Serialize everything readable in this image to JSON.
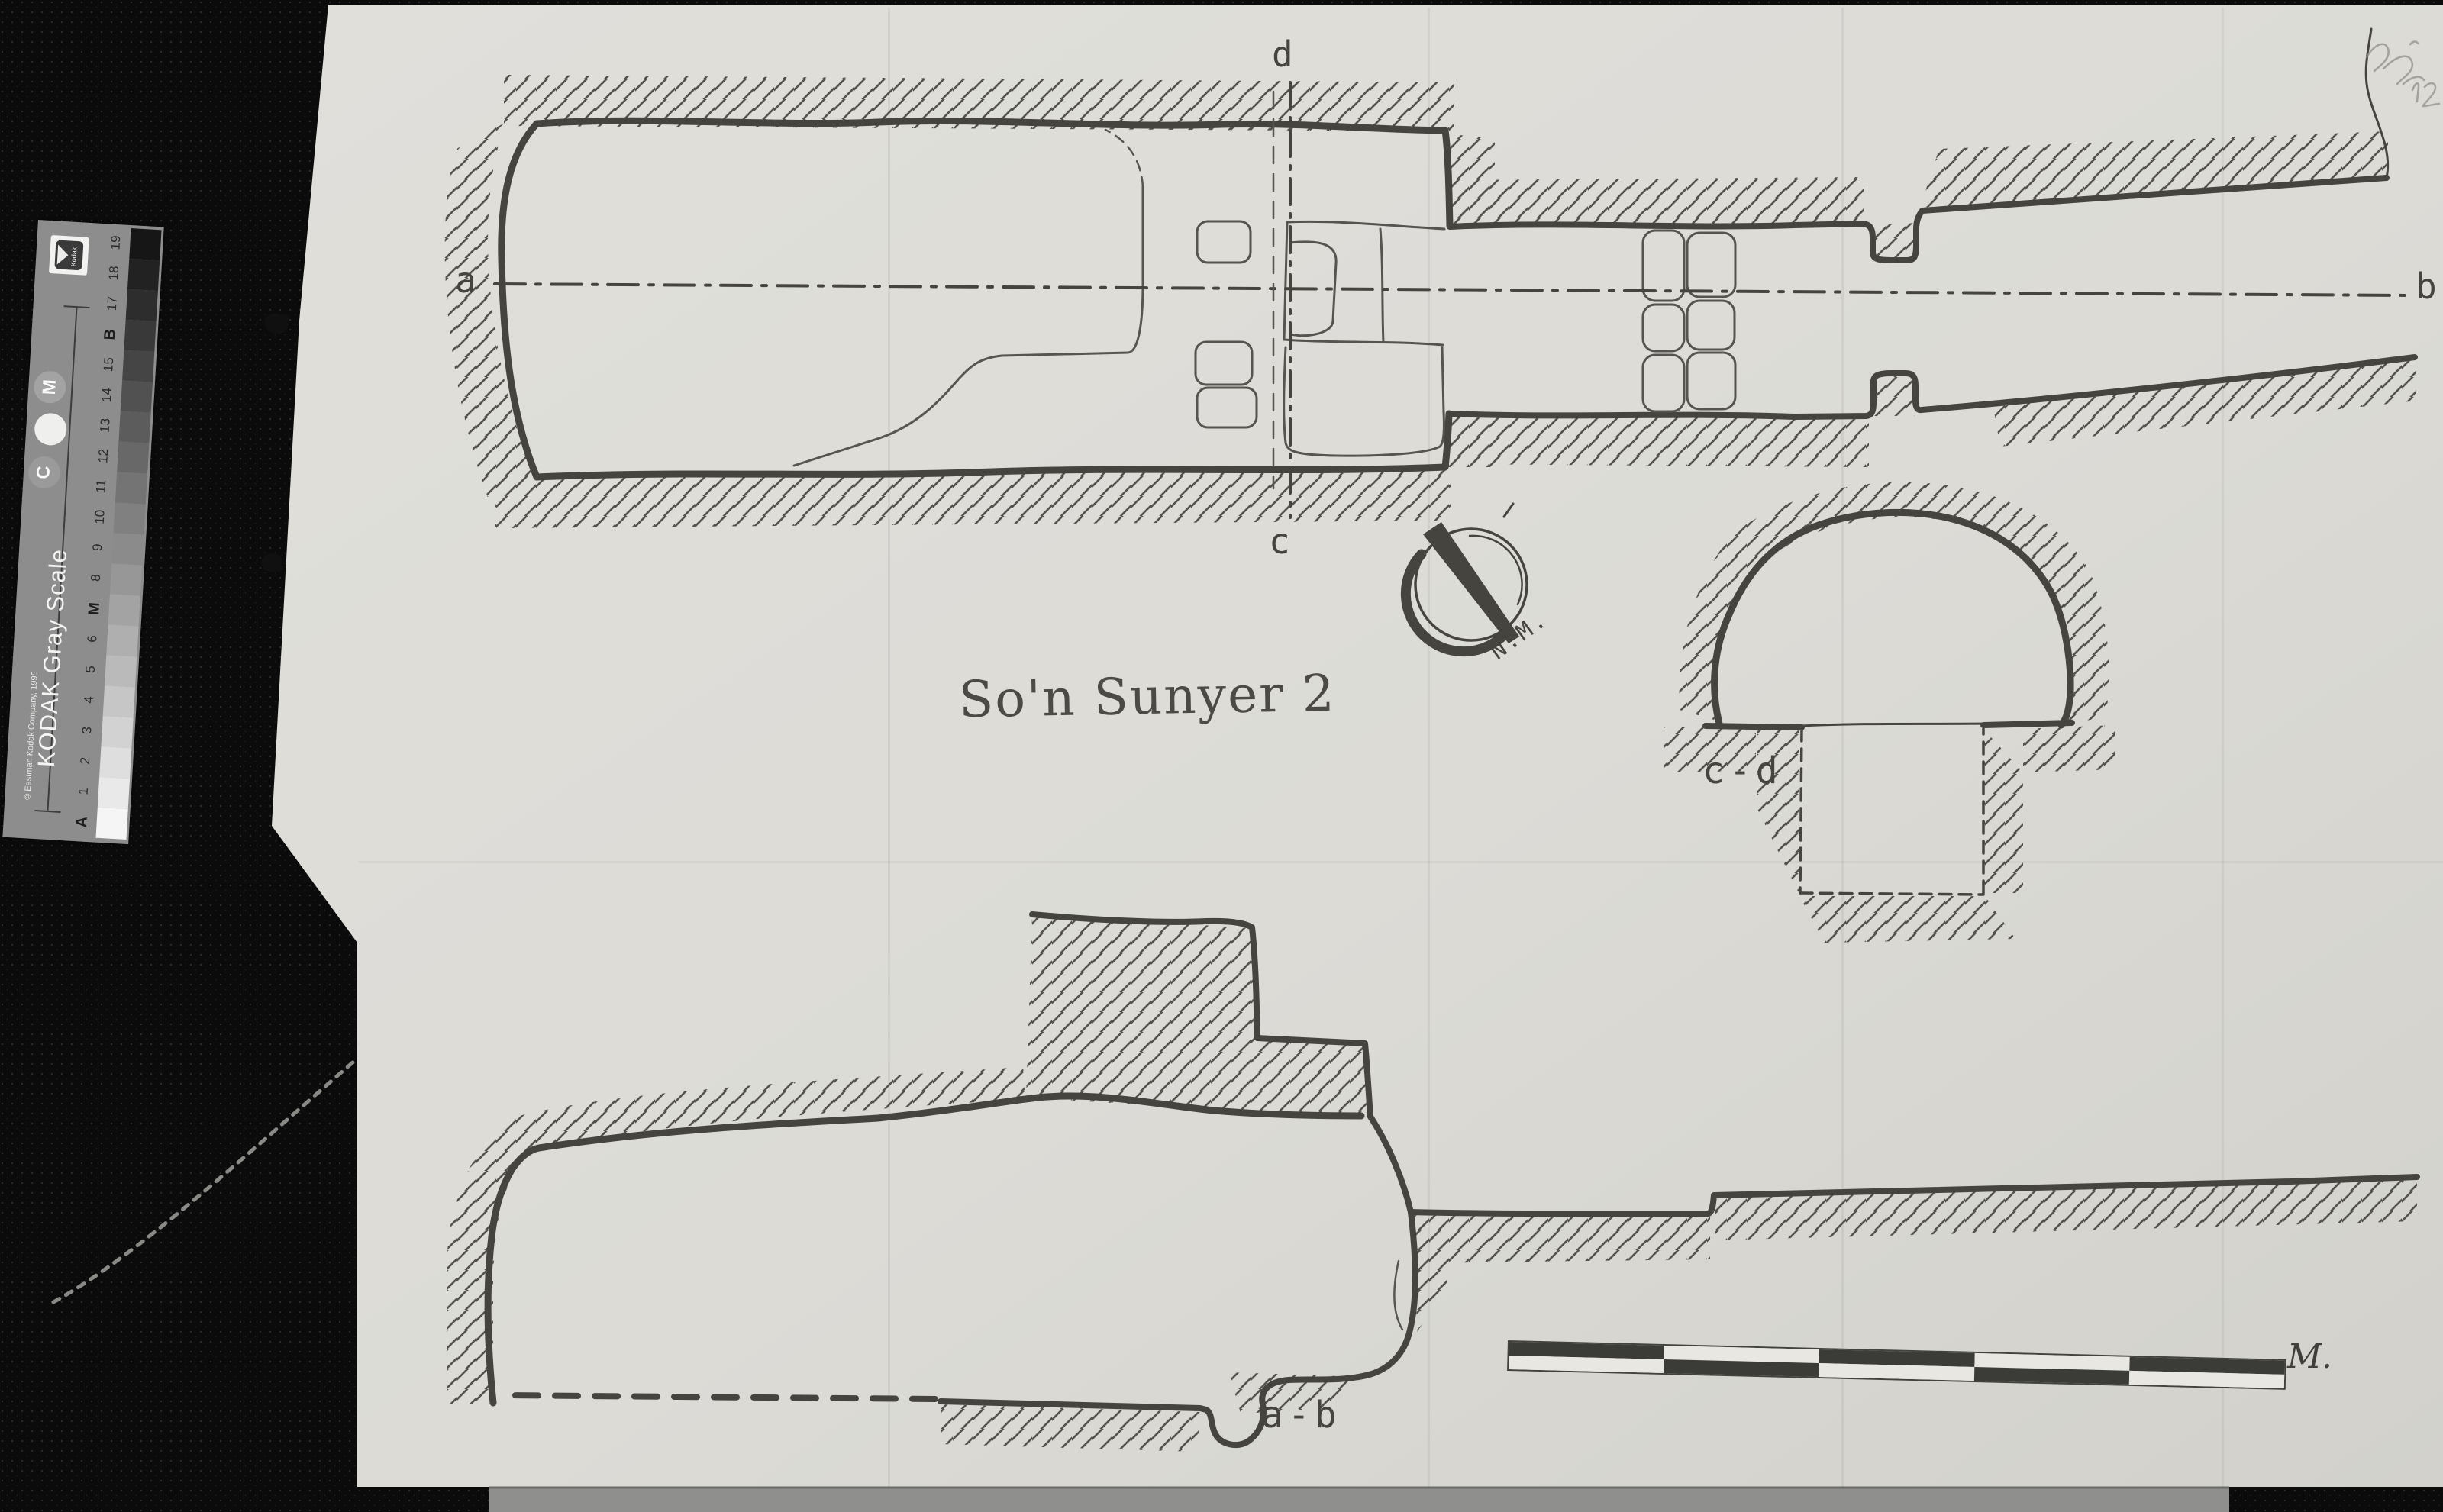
{
  "drawing": {
    "title": "So'n Sunyer 2",
    "labels": {
      "a": "a",
      "b": "b",
      "c": "c",
      "d": "d",
      "cross_section": "c-d",
      "long_section": "a-b"
    },
    "north_label": "N.M.",
    "ink_color": "#45443f"
  },
  "gray_scale_strip": {
    "product_title": "KODAK Gray Scale",
    "logo_text": "Kodak",
    "copyright_line": "© Eastman Kodak Company, 1995",
    "markers_top_to_bottom": [
      "19",
      "18",
      "17",
      "B",
      "15",
      "14",
      "13",
      "12",
      "11",
      "10",
      "9",
      "8",
      "M",
      "6",
      "5",
      "4",
      "3",
      "2",
      "1",
      "A"
    ],
    "circle_labels": {
      "top": "M",
      "bottom": "C"
    },
    "body_color": "#8d8d8d",
    "patch_dark": "#161616",
    "patch_light": "#f5f5f5"
  },
  "scale_bar": {
    "label": "M.",
    "rows": 2,
    "segments_per_row": 5,
    "dark_color": "#3b3b38",
    "light_color": "#e8e7e2"
  }
}
